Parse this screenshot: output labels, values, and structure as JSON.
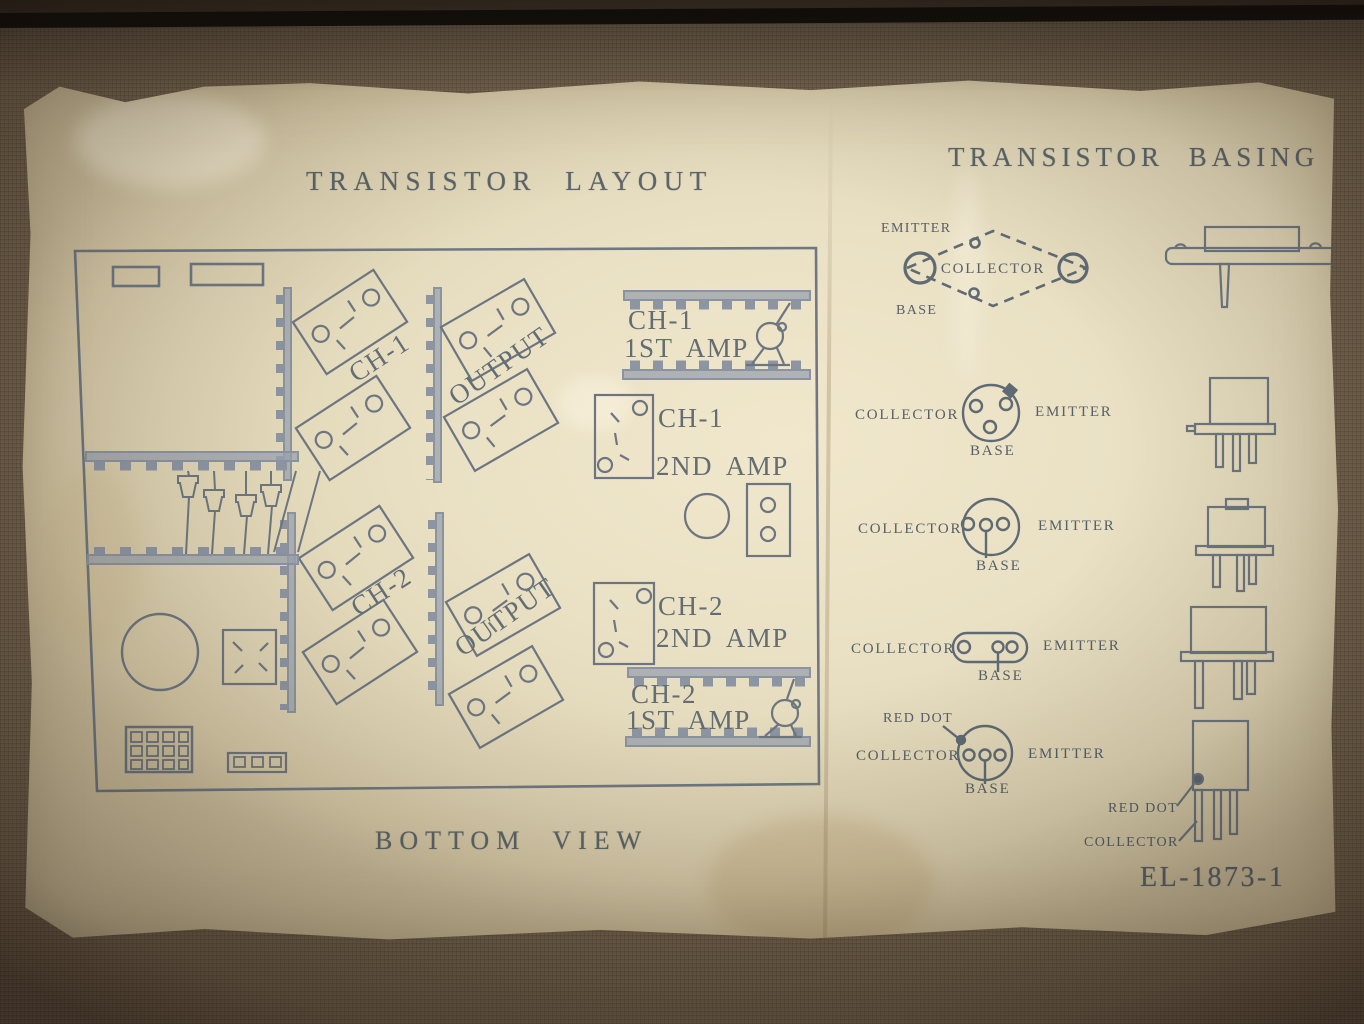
{
  "photo": {
    "titles": {
      "layout": "TRANSISTOR LAYOUT",
      "basing": "TRANSISTOR BASING"
    },
    "layout": {
      "view_label": "BOTTOM VIEW",
      "channel1": "CH-1",
      "channel2": "CH-2",
      "output": "OUTPUT",
      "amps": {
        "ch1_1st": {
          "line1": "CH-1",
          "line2": "1ST AMP"
        },
        "ch1_2nd": {
          "line1": "CH-1",
          "line2": "2ND AMP"
        },
        "ch2_2nd": {
          "line1": "CH-2",
          "line2": "2ND AMP"
        },
        "ch2_1st": {
          "line1": "CH-2",
          "line2": "1ST AMP"
        }
      }
    },
    "basing": {
      "diagrams": [
        {
          "name": "diamond-power-case",
          "emitter": "EMITTER",
          "collector": "COLLECTOR",
          "base": "BASE"
        },
        {
          "name": "round-case-tab",
          "collector": "COLLECTOR",
          "emitter": "EMITTER",
          "base": "BASE"
        },
        {
          "name": "round-case-inline",
          "collector": "COLLECTOR",
          "emitter": "EMITTER",
          "base": "BASE"
        },
        {
          "name": "oval-case",
          "collector": "COLLECTOR",
          "emitter": "EMITTER",
          "base": "BASE"
        },
        {
          "name": "round-case-red-dot",
          "red_dot": "RED DOT",
          "collector": "COLLECTOR",
          "emitter": "EMITTER",
          "base": "BASE"
        }
      ],
      "side_view_labels": {
        "red_dot": "RED DOT",
        "collector": "COLLECTOR"
      }
    },
    "doc_number": "EL-1873-1",
    "colors": {
      "ink": "#646e74",
      "ink_text": "#5b656c",
      "paper": "#e8dfc5",
      "board": "#70604c"
    }
  }
}
